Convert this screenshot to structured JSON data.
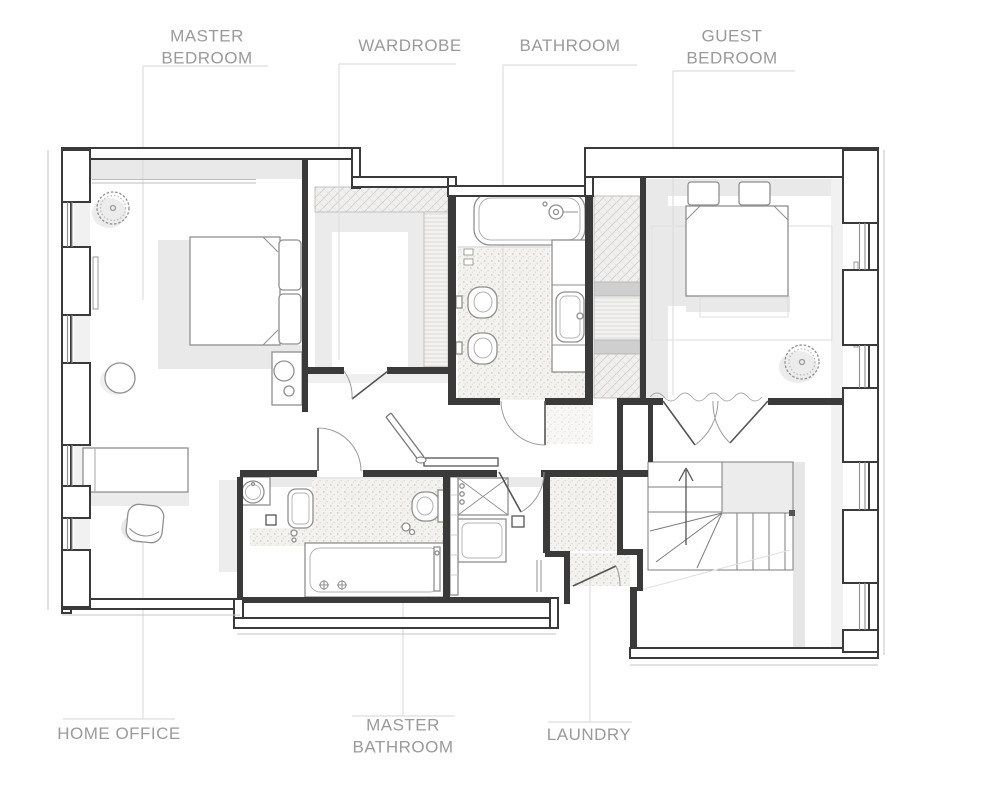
{
  "plan": {
    "type": "floor-plan",
    "labels": {
      "master_bedroom": "MASTER\nBEDROOM",
      "wardrobe": "WARDROBE",
      "bathroom": "BATHROOM",
      "guest_bedroom": "GUEST\nBEDROOM",
      "home_office": "HOME OFFICE",
      "master_bathroom": "MASTER\nBATHROOM",
      "laundry": "LAUNDRY"
    },
    "colors": {
      "wall": "#3a3a3a",
      "furniture_stroke": "#8f8f8f",
      "label_text": "#9a9a9a",
      "shadow": "#e9e9e9",
      "leader_line": "#dedede",
      "background": "#ffffff"
    }
  }
}
